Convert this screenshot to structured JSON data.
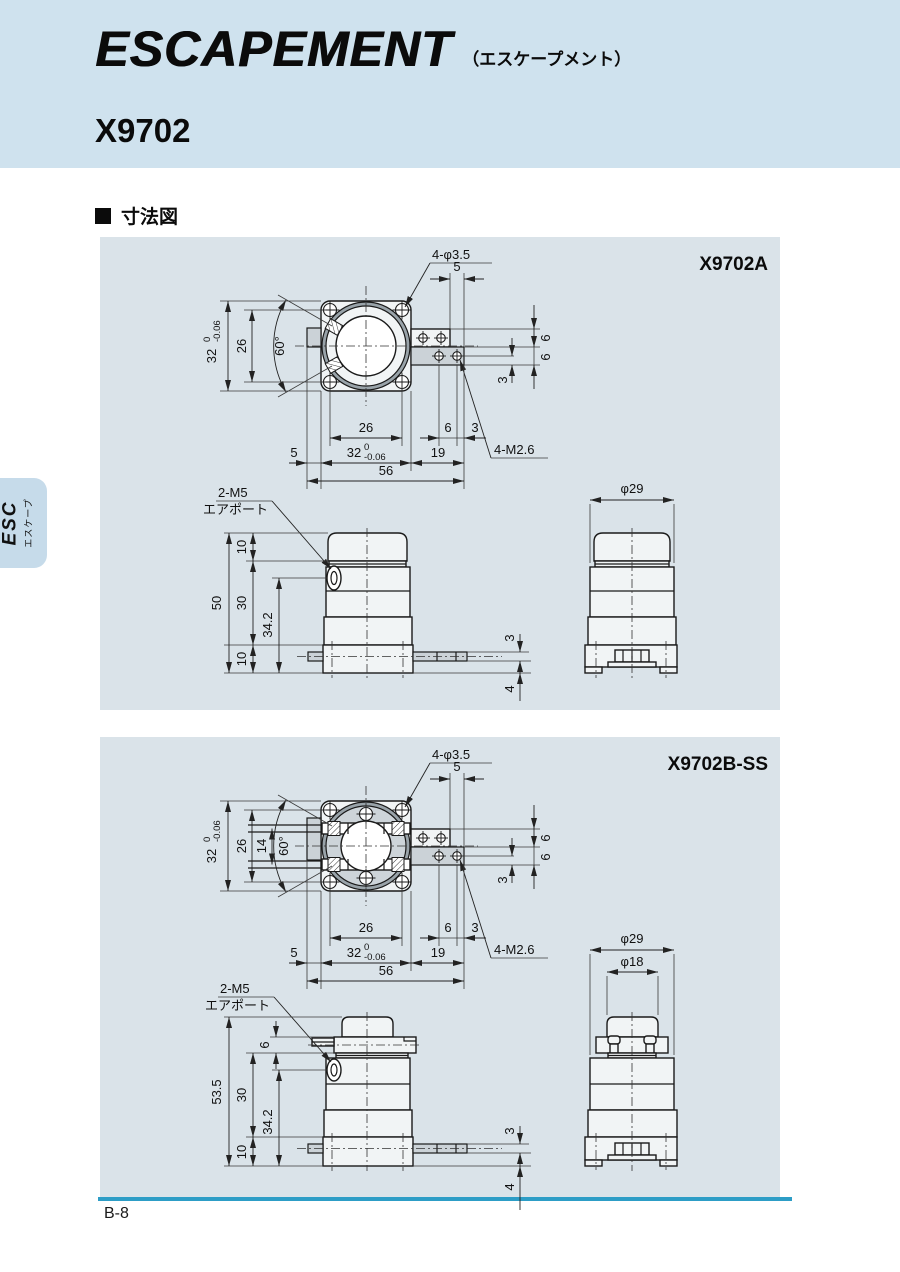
{
  "header": {
    "logo": "ESCAPEMENT",
    "logo_kana": "（エスケープメント）",
    "model": "X9702"
  },
  "section": {
    "title_text": "寸法図"
  },
  "tab": {
    "code": "ESC",
    "kana": "エスケープ"
  },
  "footer": {
    "page": "B-8"
  },
  "colors": {
    "accent_rule": "#2d9dc6",
    "header_bg": "#cfe2ee",
    "panel_bg": "#dae3e9"
  },
  "p1": {
    "title": "X9702A",
    "top": {
      "holes": "4-φ3.5",
      "span5": "5",
      "d32": "32",
      "tol0": "0",
      "tolm": "-0.06",
      "d26": "26",
      "ang": "60°",
      "r6a": "6",
      "r6b": "6",
      "r3": "3",
      "thread": "4-M2.6",
      "b26": "26",
      "b6": "6",
      "b3": "3",
      "b5": "5",
      "b32": "32",
      "btol0": "0",
      "btolm": "-0.06",
      "b19": "19",
      "b56": "56"
    },
    "side": {
      "port1": "2-M5",
      "port2": "エアポート",
      "t10": "10",
      "m30": "30",
      "p342": "34.2",
      "h50": "50",
      "b10": "10",
      "a3": "3",
      "a4": "4"
    },
    "front": {
      "dia": "φ29"
    }
  },
  "p2": {
    "title": "X9702B-SS",
    "top": {
      "holes": "4-φ3.5",
      "span5": "5",
      "d32": "32",
      "tol0": "0",
      "tolm": "-0.06",
      "d26": "26",
      "d14": "14",
      "ang": "60°",
      "r6a": "6",
      "r6b": "6",
      "r3": "3",
      "thread": "4-M2.6",
      "b26": "26",
      "b6": "6",
      "b3": "3",
      "b5": "5",
      "b32": "32",
      "btol0": "0",
      "btolm": "-0.06",
      "b19": "19",
      "b56": "56"
    },
    "side": {
      "port1": "2-M5",
      "port2": "エアポート",
      "t6": "6",
      "m30": "30",
      "p342": "34.2",
      "h535": "53.5",
      "b10": "10",
      "a3": "3",
      "a4": "4"
    },
    "front": {
      "dia": "φ29",
      "dia2": "φ18"
    }
  }
}
